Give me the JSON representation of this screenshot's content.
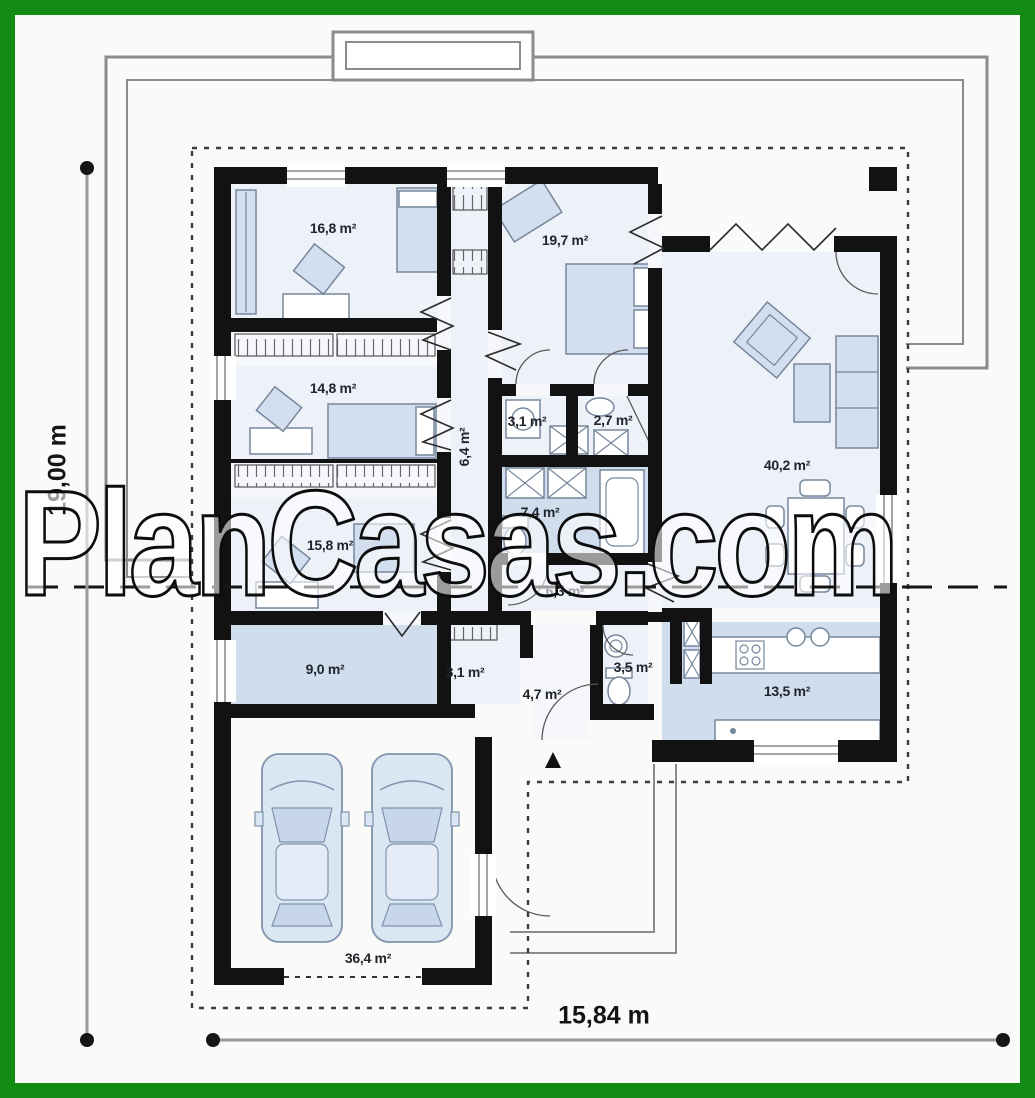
{
  "watermark": {
    "text": "PlanCasas.com"
  },
  "dimensions": {
    "vertical_label": "19,00 m",
    "horizontal_label": "15,84 m"
  },
  "rooms": [
    {
      "area": "16,8 m²"
    },
    {
      "area": "19,7 m²"
    },
    {
      "area": "14,8 m²"
    },
    {
      "area": "3,1 m²"
    },
    {
      "area": "2,7 m²"
    },
    {
      "area": "6,4 m²"
    },
    {
      "area": "7,4 m²"
    },
    {
      "area": "40,2 m²"
    },
    {
      "area": "15,8 m²"
    },
    {
      "area": "6,3 m²"
    },
    {
      "area": "9,0 m²"
    },
    {
      "area": "3,1 m²"
    },
    {
      "area": "4,7 m²"
    },
    {
      "area": "3,5 m²"
    },
    {
      "area": "13,5 m²"
    },
    {
      "area": "36,4 m²"
    }
  ],
  "colors": {
    "frame": "#128c12",
    "wall": "#121212",
    "floor_light": "#edf1f8",
    "floor_medium": "#cfdded",
    "furniture": "#d3dfef",
    "furn_stroke": "#76879c",
    "roof_gray": "#8c8c8c"
  }
}
